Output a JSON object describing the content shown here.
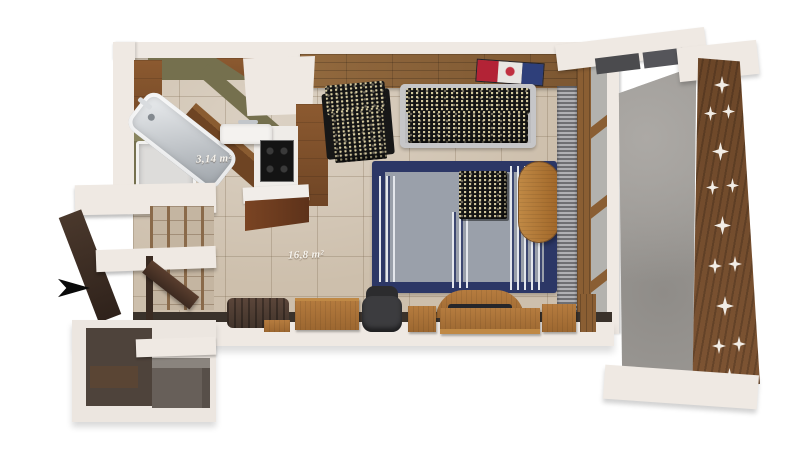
{
  "background": "#ffffff",
  "labels": {
    "bathroom_area": "3,14 m²",
    "main_room_area": "16,8 m²"
  },
  "icons": {
    "entrance_arrow": "right-arrow"
  },
  "palette": {
    "wall_white": "#efe9e3",
    "floor_tile_beige": "#cdbfac",
    "wood_plank_wall": "#8a6138",
    "cabinet_wood": "#8c5a30",
    "furniture_wood": "#b0763c",
    "bathroom_olive": "#75704e",
    "stainless_steel": "#c9ced2",
    "rug_navy": "#2c3766",
    "rug_gray": "#9aa0aa",
    "upholstery_black": "#151515",
    "sofa_gray": "#bcbcbe",
    "office_chair_dark": "#3a3a3c",
    "balcony_concrete": "#9c9995",
    "privacy_screen_wood": "#6f4a2c",
    "art_red": "#b32336",
    "art_blue": "#2e3f7a",
    "arrow_black": "#0a0a0a"
  }
}
